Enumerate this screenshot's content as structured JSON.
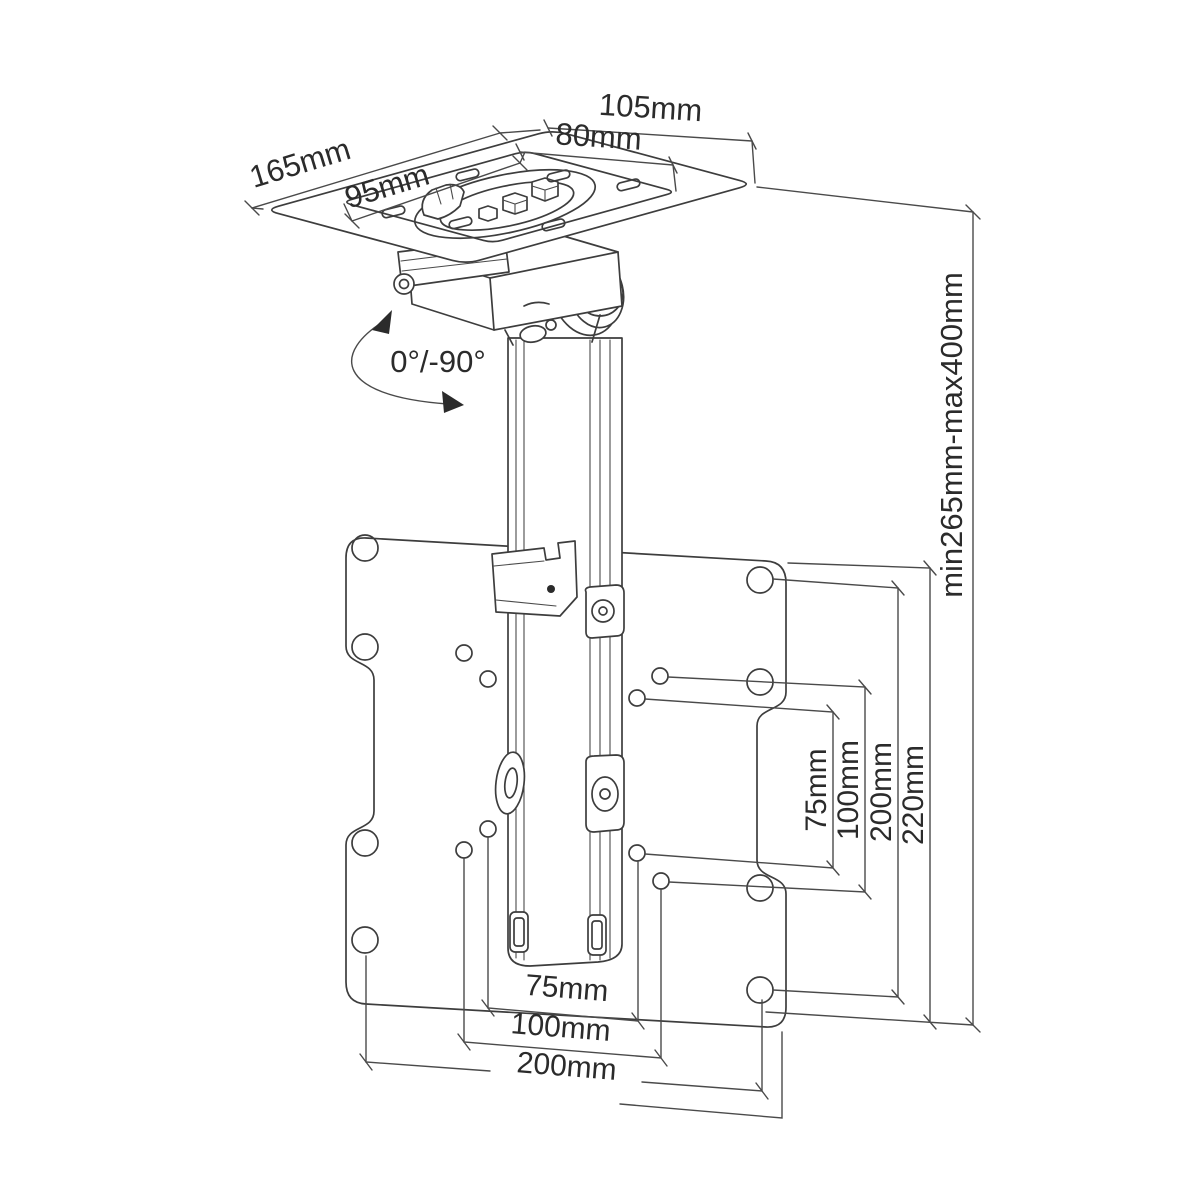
{
  "diagram": {
    "subject": "ceiling TV mount bracket technical drawing",
    "labels": {
      "plate_width_outer": "105mm",
      "plate_width_inner": "80mm",
      "plate_depth_outer": "165mm",
      "plate_depth_inner": "95mm",
      "tilt_range": "0°/-90°",
      "height_range": "min265mm-max400mm",
      "vesa_vertical": [
        {
          "text": "75mm"
        },
        {
          "text": "100mm"
        },
        {
          "text": "200mm"
        },
        {
          "text": "220mm"
        }
      ],
      "vesa_horizontal": [
        {
          "text": "75mm"
        },
        {
          "text": "100mm"
        },
        {
          "text": "200mm"
        }
      ]
    },
    "line_color": "#3d3d3d",
    "background_color": "#ffffff"
  }
}
